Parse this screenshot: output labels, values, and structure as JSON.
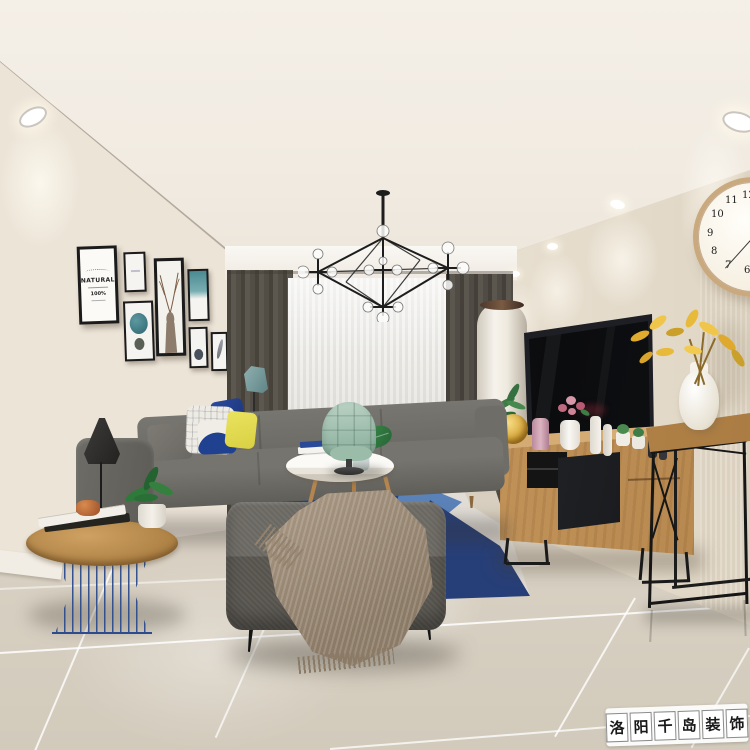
{
  "scene": {
    "description": "Modern nordic living room interior render",
    "watermark_present": true
  },
  "watermark": {
    "text": "洛阳千岛装饰",
    "chars": [
      "洛",
      "阳",
      "千",
      "岛",
      "装",
      "饰"
    ]
  },
  "gallery_poster": {
    "title": "NATURAL",
    "percent_text": "100%"
  },
  "clock": {
    "visible_numerals": [
      "12",
      "11",
      "10",
      "9",
      "8",
      "7",
      "6"
    ],
    "time_shown": "12:00"
  },
  "palette": {
    "ceiling": "#f2ece3",
    "wall": "#eae2d4",
    "back_wall": "#e7dfd2",
    "floor": "#ded6c8",
    "curtain_dark": "#534c42",
    "sheer": "#ecebe7",
    "sofa_gray": "#6e6c66",
    "ottoman_gray": "#5c5953",
    "blanket_taupe": "#9b8a75",
    "armchair_mint": "#a9c7b6",
    "rug_navy": "#26407c",
    "rug_blue": "#5b82b8",
    "rug_pale_blue": "#b9c9d6",
    "wood": "#c0924f",
    "tv_black": "#0d0e10",
    "metal_black": "#1a1a1a",
    "clock_rim": "#c9a97d",
    "gold_vase": "#d8a93f",
    "flower_yellow": "#e3b23a",
    "pillow_navy": "#1f3f8f",
    "pillow_yellow": "#e4dc52",
    "wire_table_blue": "#2c4c8e",
    "copper": "#b4623a",
    "lamp_teal": "#7b9fa0"
  }
}
